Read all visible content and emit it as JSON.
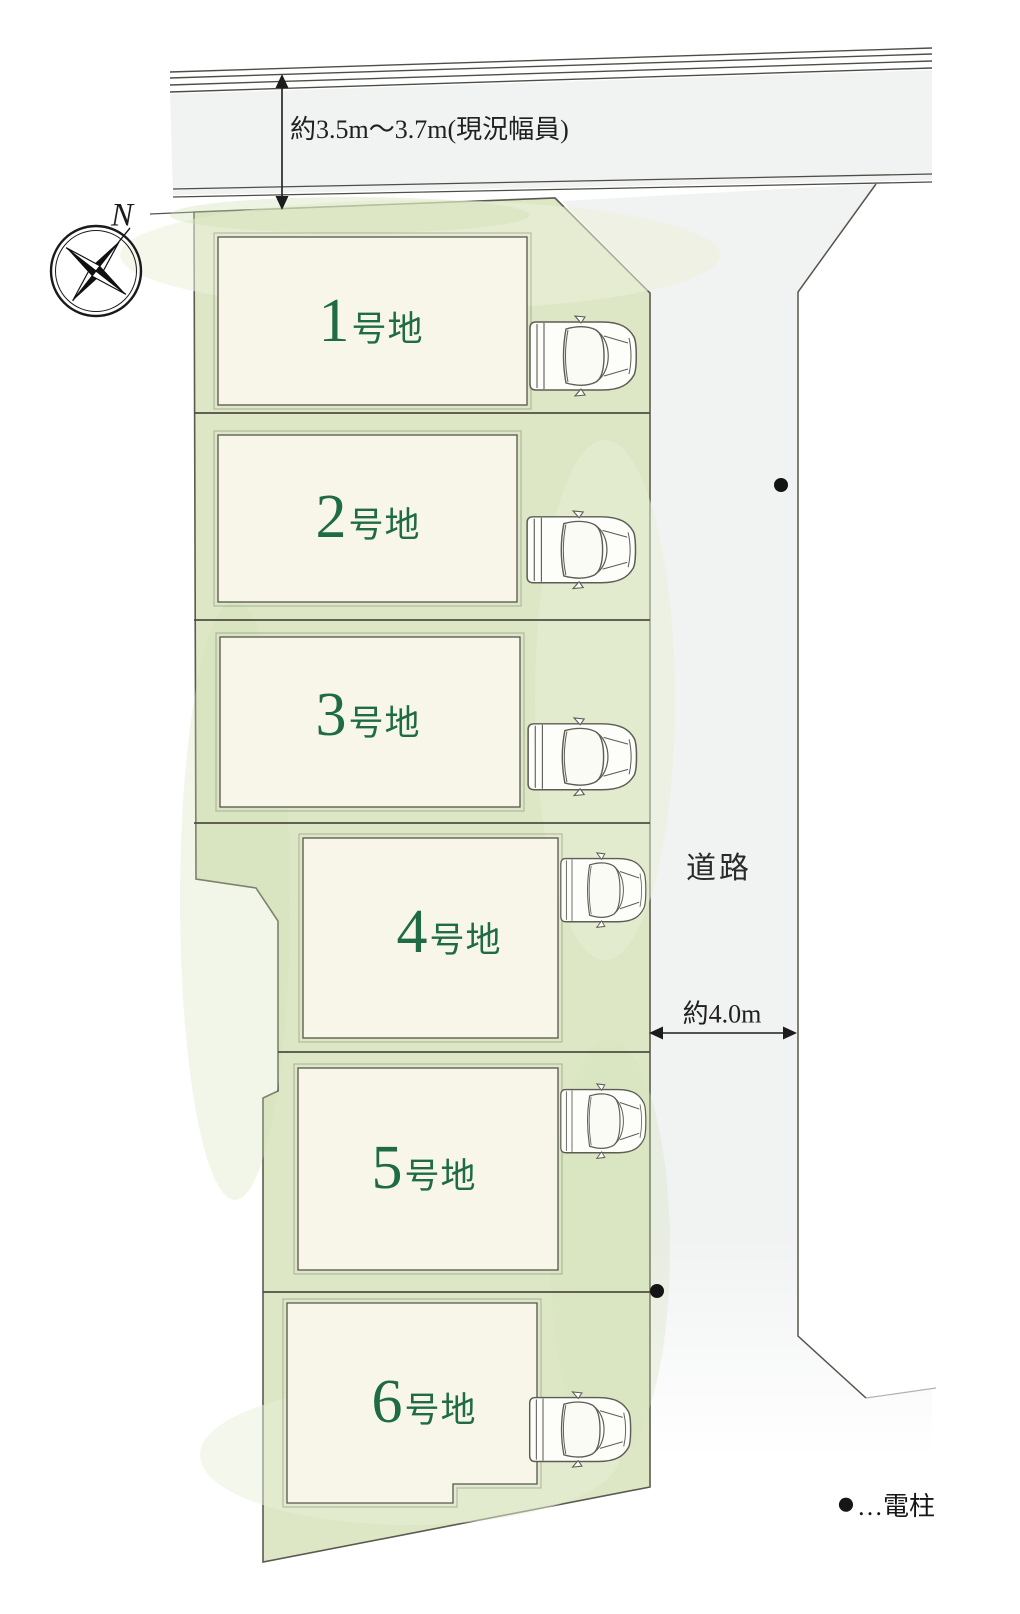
{
  "plan": {
    "title": "宅地分譲区画図",
    "compass": {
      "north_label": "N"
    },
    "north_road": {
      "width_note": "約3.5m〜3.7m(現況幅員)"
    },
    "east_road": {
      "label": "道路",
      "width_note": "約4.0m"
    },
    "lots": [
      {
        "number": "1",
        "suffix": "号地"
      },
      {
        "number": "2",
        "suffix": "号地"
      },
      {
        "number": "3",
        "suffix": "号地"
      },
      {
        "number": "4",
        "suffix": "号地"
      },
      {
        "number": "5",
        "suffix": "号地"
      },
      {
        "number": "6",
        "suffix": "号地"
      }
    ],
    "legend": {
      "symbol": "●",
      "text": "…電柱"
    },
    "colors": {
      "lot_text_green": "#1e6b46",
      "parcel_green": "#dde7c6",
      "building_cream": "#f8f6e8",
      "road_gray": "#f1f2f2",
      "outline": "#55554b"
    }
  }
}
